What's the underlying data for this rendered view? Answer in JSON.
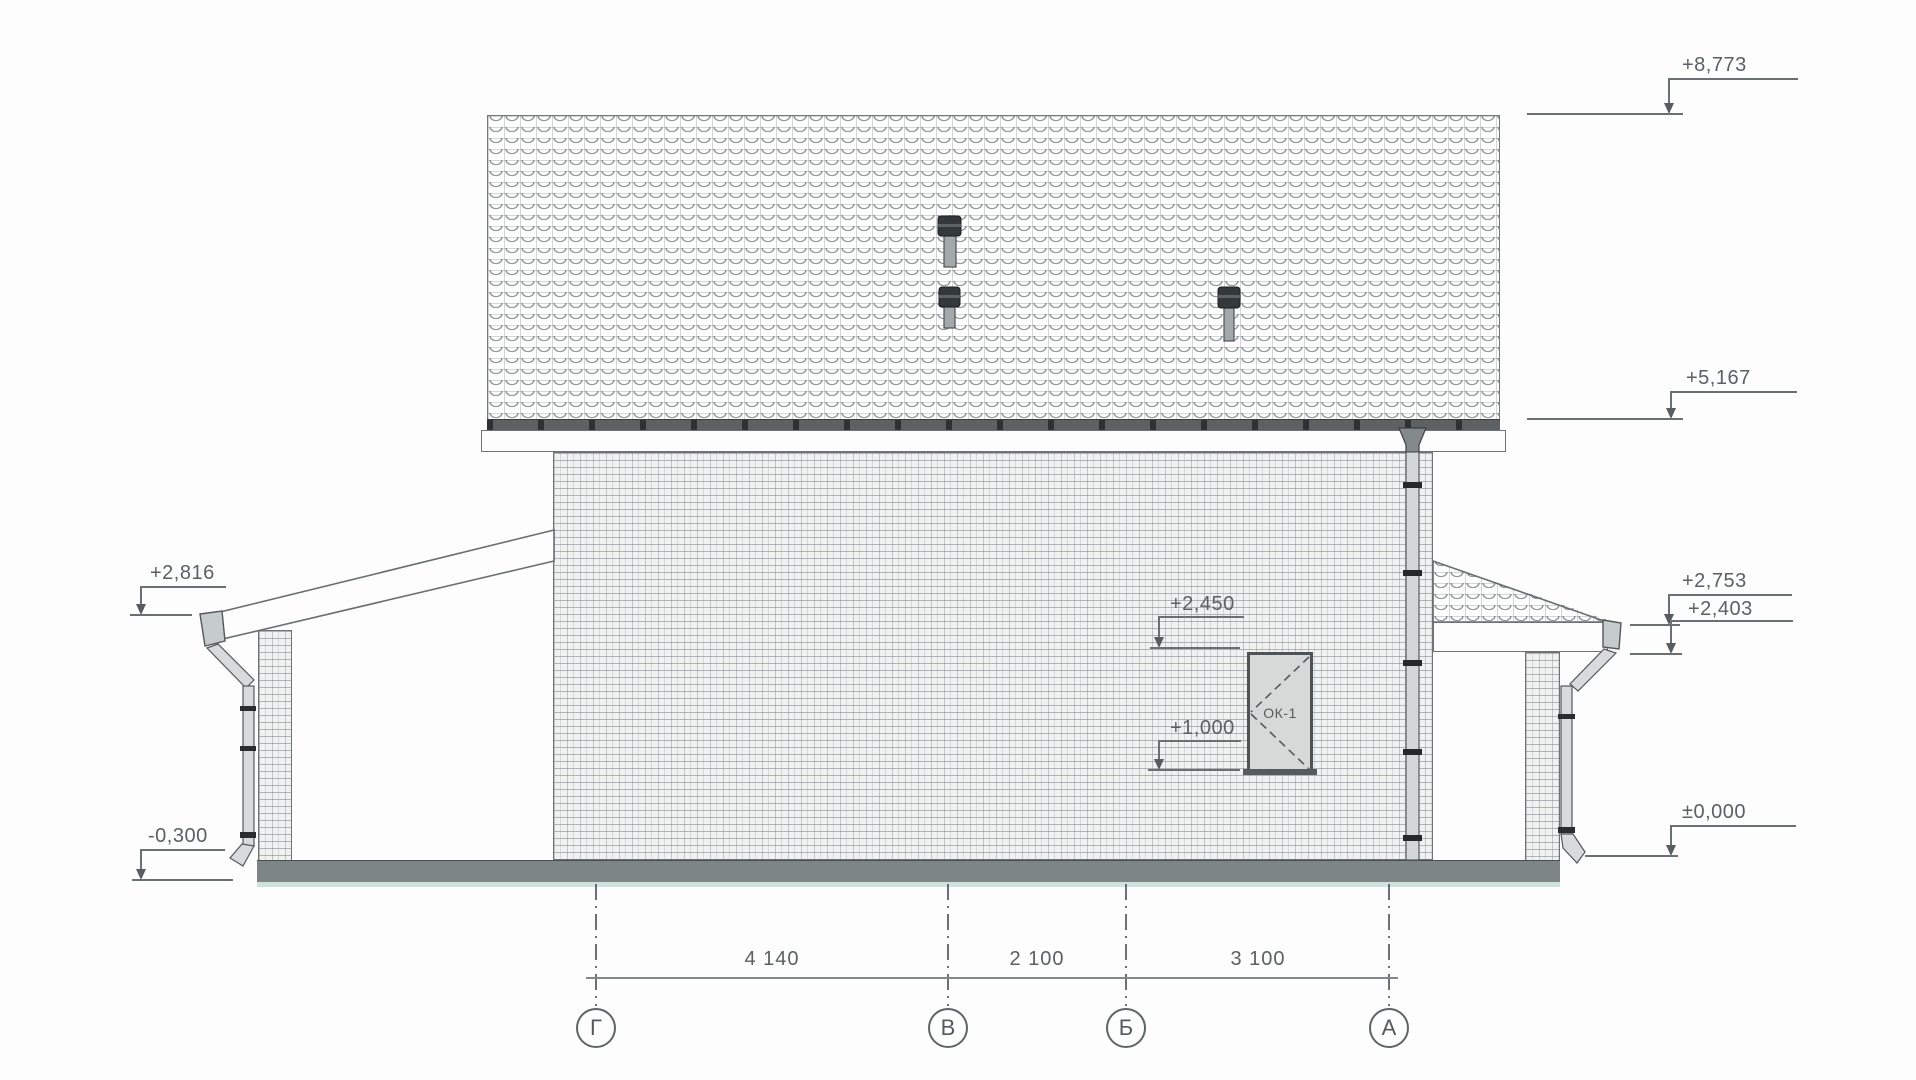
{
  "drawing": {
    "elevations": {
      "ridge": "+8,773",
      "eave": "+5,167",
      "canopy_left": "+2,816",
      "ground_left": "-0,300",
      "canopy_right_top": "+2,753",
      "canopy_right_bottom": "+2,403",
      "ground_zero": "±0,000",
      "window_head": "+2,450",
      "window_sill": "+1,000"
    },
    "window_label": "ОК-1",
    "axes": [
      {
        "label": "Г"
      },
      {
        "label": "В"
      },
      {
        "label": "Б"
      },
      {
        "label": "А"
      }
    ],
    "dims": [
      {
        "value": "4 140"
      },
      {
        "value": "2 100"
      },
      {
        "value": "3 100"
      }
    ],
    "colors": {
      "line": "#6a6f72",
      "text": "#5b6063",
      "plinth": "#7e8587",
      "plinth_accent": "#cfe2db",
      "glass": "#d5d9d7"
    }
  }
}
